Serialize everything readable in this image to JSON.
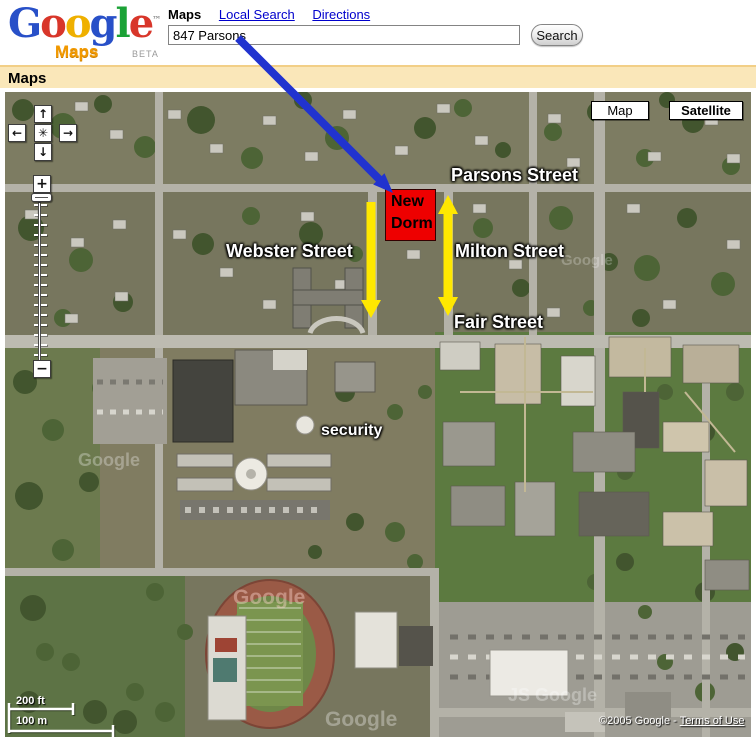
{
  "header": {
    "logo": {
      "g1": "G",
      "o1": "o",
      "o2": "o",
      "g2": "g",
      "l1": "l",
      "e1": "e",
      "tm": "™",
      "maps": "Maps",
      "beta": "BETA"
    },
    "nav": {
      "maps": "Maps",
      "local_search": "Local Search",
      "directions": "Directions"
    },
    "search": {
      "value": "847 Parsons",
      "button": "Search"
    }
  },
  "title_bar": {
    "label": "Maps"
  },
  "map": {
    "view_buttons": {
      "map": "Map",
      "satellite": "Satellite"
    },
    "pan": {
      "up": "↑",
      "left": "←",
      "right": "→",
      "down": "↓",
      "center": "✳"
    },
    "zoom": {
      "in": "+",
      "out": "−"
    },
    "labels": {
      "parsons": "Parsons Street",
      "webster": "Webster Street",
      "milton": "Milton Street",
      "fair": "Fair Street",
      "security": "security"
    },
    "marker": {
      "line1": "New",
      "line2": "Dorm"
    },
    "scale": {
      "feet": "200 ft",
      "meters": "100 m"
    },
    "copyright": {
      "text": "©2005 Google - ",
      "terms_link": "Terms of Use"
    },
    "watermarks": [
      "Google",
      "Google",
      "Google",
      "JS Google",
      "Google"
    ],
    "colors": {
      "marker_red": "#ee0000",
      "arrow_yellow": "#ffe800",
      "arrow_blue": "#2133cf",
      "label_white": "#ffffff"
    }
  }
}
